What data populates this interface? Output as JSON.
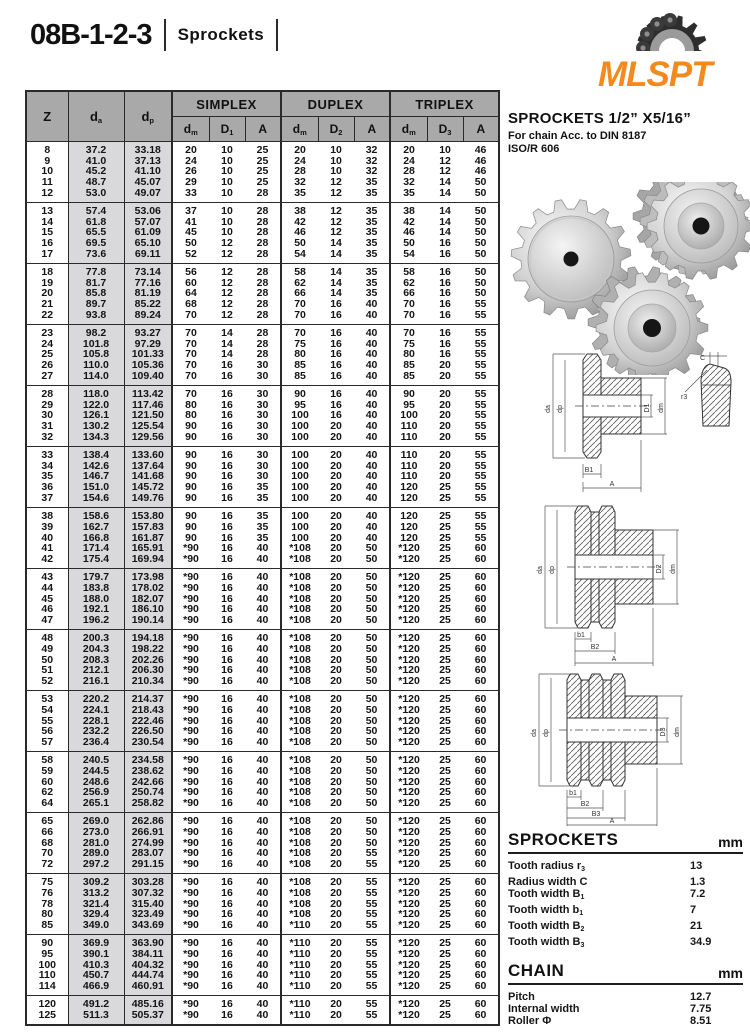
{
  "page": {
    "title": "08B-1-2-3",
    "subtitle": "Sprockets",
    "logo_text": "MLSPT",
    "accent_color": "#F28A1E"
  },
  "table": {
    "header": {
      "z": "Z",
      "da": {
        "b": "d",
        "s": "a"
      },
      "dp": {
        "b": "d",
        "s": "p"
      },
      "groups": [
        "SIMPLEX",
        "DUPLEX",
        "TRIPLEX"
      ],
      "subcols": [
        {
          "b": "d",
          "s": "m"
        },
        {
          "b": "D",
          "s": "1"
        },
        {
          "b": "A",
          "s": ""
        },
        {
          "b": "d",
          "s": "m"
        },
        {
          "b": "D",
          "s": "2"
        },
        {
          "b": "A",
          "s": ""
        },
        {
          "b": "d",
          "s": "m"
        },
        {
          "b": "D",
          "s": "3"
        },
        {
          "b": "A",
          "s": ""
        }
      ]
    },
    "groups": [
      [
        [
          "8",
          "37.2",
          "33.18",
          "20",
          "10",
          "25",
          "20",
          "10",
          "32",
          "20",
          "10",
          "46"
        ],
        [
          "9",
          "41.0",
          "37.13",
          "24",
          "10",
          "25",
          "24",
          "10",
          "32",
          "24",
          "12",
          "46"
        ],
        [
          "10",
          "45.2",
          "41.10",
          "26",
          "10",
          "25",
          "28",
          "10",
          "32",
          "28",
          "12",
          "46"
        ],
        [
          "11",
          "48.7",
          "45.07",
          "29",
          "10",
          "25",
          "32",
          "12",
          "35",
          "32",
          "14",
          "50"
        ],
        [
          "12",
          "53.0",
          "49.07",
          "33",
          "10",
          "28",
          "35",
          "12",
          "35",
          "35",
          "14",
          "50"
        ]
      ],
      [
        [
          "13",
          "57.4",
          "53.06",
          "37",
          "10",
          "28",
          "38",
          "12",
          "35",
          "38",
          "14",
          "50"
        ],
        [
          "14",
          "61.8",
          "57.07",
          "41",
          "10",
          "28",
          "42",
          "12",
          "35",
          "42",
          "14",
          "50"
        ],
        [
          "15",
          "65.5",
          "61.09",
          "45",
          "10",
          "28",
          "46",
          "12",
          "35",
          "46",
          "14",
          "50"
        ],
        [
          "16",
          "69.5",
          "65.10",
          "50",
          "12",
          "28",
          "50",
          "14",
          "35",
          "50",
          "16",
          "50"
        ],
        [
          "17",
          "73.6",
          "69.11",
          "52",
          "12",
          "28",
          "54",
          "14",
          "35",
          "54",
          "16",
          "50"
        ]
      ],
      [
        [
          "18",
          "77.8",
          "73.14",
          "56",
          "12",
          "28",
          "58",
          "14",
          "35",
          "58",
          "16",
          "50"
        ],
        [
          "19",
          "81.7",
          "77.16",
          "60",
          "12",
          "28",
          "62",
          "14",
          "35",
          "62",
          "16",
          "50"
        ],
        [
          "20",
          "85.8",
          "81.19",
          "64",
          "12",
          "28",
          "66",
          "14",
          "35",
          "66",
          "16",
          "50"
        ],
        [
          "21",
          "89.7",
          "85.22",
          "68",
          "12",
          "28",
          "70",
          "16",
          "40",
          "70",
          "16",
          "55"
        ],
        [
          "22",
          "93.8",
          "89.24",
          "70",
          "12",
          "28",
          "70",
          "16",
          "40",
          "70",
          "16",
          "55"
        ]
      ],
      [
        [
          "23",
          "98.2",
          "93.27",
          "70",
          "14",
          "28",
          "70",
          "16",
          "40",
          "70",
          "16",
          "55"
        ],
        [
          "24",
          "101.8",
          "97.29",
          "70",
          "14",
          "28",
          "75",
          "16",
          "40",
          "75",
          "16",
          "55"
        ],
        [
          "25",
          "105.8",
          "101.33",
          "70",
          "14",
          "28",
          "80",
          "16",
          "40",
          "80",
          "16",
          "55"
        ],
        [
          "26",
          "110.0",
          "105.36",
          "70",
          "16",
          "30",
          "85",
          "16",
          "40",
          "85",
          "20",
          "55"
        ],
        [
          "27",
          "114.0",
          "109.40",
          "70",
          "16",
          "30",
          "85",
          "16",
          "40",
          "85",
          "20",
          "55"
        ]
      ],
      [
        [
          "28",
          "118.0",
          "113.42",
          "70",
          "16",
          "30",
          "90",
          "16",
          "40",
          "90",
          "20",
          "55"
        ],
        [
          "29",
          "122.0",
          "117.46",
          "80",
          "16",
          "30",
          "95",
          "16",
          "40",
          "95",
          "20",
          "55"
        ],
        [
          "30",
          "126.1",
          "121.50",
          "80",
          "16",
          "30",
          "100",
          "16",
          "40",
          "100",
          "20",
          "55"
        ],
        [
          "31",
          "130.2",
          "125.54",
          "90",
          "16",
          "30",
          "100",
          "20",
          "40",
          "110",
          "20",
          "55"
        ],
        [
          "32",
          "134.3",
          "129.56",
          "90",
          "16",
          "30",
          "100",
          "20",
          "40",
          "110",
          "20",
          "55"
        ]
      ],
      [
        [
          "33",
          "138.4",
          "133.60",
          "90",
          "16",
          "30",
          "100",
          "20",
          "40",
          "110",
          "20",
          "55"
        ],
        [
          "34",
          "142.6",
          "137.64",
          "90",
          "16",
          "30",
          "100",
          "20",
          "40",
          "110",
          "20",
          "55"
        ],
        [
          "35",
          "146.7",
          "141.68",
          "90",
          "16",
          "30",
          "100",
          "20",
          "40",
          "110",
          "20",
          "55"
        ],
        [
          "36",
          "151.0",
          "145.72",
          "90",
          "16",
          "35",
          "100",
          "20",
          "40",
          "120",
          "25",
          "55"
        ],
        [
          "37",
          "154.6",
          "149.76",
          "90",
          "16",
          "35",
          "100",
          "20",
          "40",
          "120",
          "25",
          "55"
        ]
      ],
      [
        [
          "38",
          "158.6",
          "153.80",
          "90",
          "16",
          "35",
          "100",
          "20",
          "40",
          "120",
          "25",
          "55"
        ],
        [
          "39",
          "162.7",
          "157.83",
          "90",
          "16",
          "35",
          "100",
          "20",
          "40",
          "120",
          "25",
          "55"
        ],
        [
          "40",
          "166.8",
          "161.87",
          "90",
          "16",
          "35",
          "100",
          "20",
          "40",
          "120",
          "25",
          "55"
        ],
        [
          "41",
          "171.4",
          "165.91",
          "*90",
          "16",
          "40",
          "*108",
          "20",
          "50",
          "*120",
          "25",
          "60"
        ],
        [
          "42",
          "175.4",
          "169.94",
          "*90",
          "16",
          "40",
          "*108",
          "20",
          "50",
          "*120",
          "25",
          "60"
        ]
      ],
      [
        [
          "43",
          "179.7",
          "173.98",
          "*90",
          "16",
          "40",
          "*108",
          "20",
          "50",
          "*120",
          "25",
          "60"
        ],
        [
          "44",
          "183.8",
          "178.02",
          "*90",
          "16",
          "40",
          "*108",
          "20",
          "50",
          "*120",
          "25",
          "60"
        ],
        [
          "45",
          "188.0",
          "182.07",
          "*90",
          "16",
          "40",
          "*108",
          "20",
          "50",
          "*120",
          "25",
          "60"
        ],
        [
          "46",
          "192.1",
          "186.10",
          "*90",
          "16",
          "40",
          "*108",
          "20",
          "50",
          "*120",
          "25",
          "60"
        ],
        [
          "47",
          "196.2",
          "190.14",
          "*90",
          "16",
          "40",
          "*108",
          "20",
          "50",
          "*120",
          "25",
          "60"
        ]
      ],
      [
        [
          "48",
          "200.3",
          "194.18",
          "*90",
          "16",
          "40",
          "*108",
          "20",
          "50",
          "*120",
          "25",
          "60"
        ],
        [
          "49",
          "204.3",
          "198.22",
          "*90",
          "16",
          "40",
          "*108",
          "20",
          "50",
          "*120",
          "25",
          "60"
        ],
        [
          "50",
          "208.3",
          "202.26",
          "*90",
          "16",
          "40",
          "*108",
          "20",
          "50",
          "*120",
          "25",
          "60"
        ],
        [
          "51",
          "212.1",
          "206.30",
          "*90",
          "16",
          "40",
          "*108",
          "20",
          "50",
          "*120",
          "25",
          "60"
        ],
        [
          "52",
          "216.1",
          "210.34",
          "*90",
          "16",
          "40",
          "*108",
          "20",
          "50",
          "*120",
          "25",
          "60"
        ]
      ],
      [
        [
          "53",
          "220.2",
          "214.37",
          "*90",
          "16",
          "40",
          "*108",
          "20",
          "50",
          "*120",
          "25",
          "60"
        ],
        [
          "54",
          "224.1",
          "218.43",
          "*90",
          "16",
          "40",
          "*108",
          "20",
          "50",
          "*120",
          "25",
          "60"
        ],
        [
          "55",
          "228.1",
          "222.46",
          "*90",
          "16",
          "40",
          "*108",
          "20",
          "50",
          "*120",
          "25",
          "60"
        ],
        [
          "56",
          "232.2",
          "226.50",
          "*90",
          "16",
          "40",
          "*108",
          "20",
          "50",
          "*120",
          "25",
          "60"
        ],
        [
          "57",
          "236.4",
          "230.54",
          "*90",
          "16",
          "40",
          "*108",
          "20",
          "50",
          "*120",
          "25",
          "60"
        ]
      ],
      [
        [
          "58",
          "240.5",
          "234.58",
          "*90",
          "16",
          "40",
          "*108",
          "20",
          "50",
          "*120",
          "25",
          "60"
        ],
        [
          "59",
          "244.5",
          "238.62",
          "*90",
          "16",
          "40",
          "*108",
          "20",
          "50",
          "*120",
          "25",
          "60"
        ],
        [
          "60",
          "248.6",
          "242.66",
          "*90",
          "16",
          "40",
          "*108",
          "20",
          "50",
          "*120",
          "25",
          "60"
        ],
        [
          "62",
          "256.9",
          "250.74",
          "*90",
          "16",
          "40",
          "*108",
          "20",
          "50",
          "*120",
          "25",
          "60"
        ],
        [
          "64",
          "265.1",
          "258.82",
          "*90",
          "16",
          "40",
          "*108",
          "20",
          "50",
          "*120",
          "25",
          "60"
        ]
      ],
      [
        [
          "65",
          "269.0",
          "262.86",
          "*90",
          "16",
          "40",
          "*108",
          "20",
          "50",
          "*120",
          "25",
          "60"
        ],
        [
          "66",
          "273.0",
          "266.91",
          "*90",
          "16",
          "40",
          "*108",
          "20",
          "50",
          "*120",
          "25",
          "60"
        ],
        [
          "68",
          "281.0",
          "274.99",
          "*90",
          "16",
          "40",
          "*108",
          "20",
          "50",
          "*120",
          "25",
          "60"
        ],
        [
          "70",
          "289.0",
          "283.07",
          "*90",
          "16",
          "40",
          "*108",
          "20",
          "55",
          "*120",
          "25",
          "60"
        ],
        [
          "72",
          "297.2",
          "291.15",
          "*90",
          "16",
          "40",
          "*108",
          "20",
          "55",
          "*120",
          "25",
          "60"
        ]
      ],
      [
        [
          "75",
          "309.2",
          "303.28",
          "*90",
          "16",
          "40",
          "*108",
          "20",
          "55",
          "*120",
          "25",
          "60"
        ],
        [
          "76",
          "313.2",
          "307.32",
          "*90",
          "16",
          "40",
          "*108",
          "20",
          "55",
          "*120",
          "25",
          "60"
        ],
        [
          "78",
          "321.4",
          "315.40",
          "*90",
          "16",
          "40",
          "*108",
          "20",
          "55",
          "*120",
          "25",
          "60"
        ],
        [
          "80",
          "329.4",
          "323.49",
          "*90",
          "16",
          "40",
          "*108",
          "20",
          "55",
          "*120",
          "25",
          "60"
        ],
        [
          "85",
          "349.0",
          "343.69",
          "*90",
          "16",
          "40",
          "*110",
          "20",
          "55",
          "*120",
          "25",
          "60"
        ]
      ],
      [
        [
          "90",
          "369.9",
          "363.90",
          "*90",
          "16",
          "40",
          "*110",
          "20",
          "55",
          "*120",
          "25",
          "60"
        ],
        [
          "95",
          "390.1",
          "384.11",
          "*90",
          "16",
          "40",
          "*110",
          "20",
          "55",
          "*120",
          "25",
          "60"
        ],
        [
          "100",
          "410.3",
          "404.32",
          "*90",
          "16",
          "40",
          "*110",
          "20",
          "55",
          "*120",
          "25",
          "60"
        ],
        [
          "110",
          "450.7",
          "444.74",
          "*90",
          "16",
          "40",
          "*110",
          "20",
          "55",
          "*120",
          "25",
          "60"
        ],
        [
          "114",
          "466.9",
          "460.91",
          "*90",
          "16",
          "40",
          "*110",
          "20",
          "55",
          "*120",
          "25",
          "60"
        ]
      ],
      [
        [
          "120",
          "491.2",
          "485.16",
          "*90",
          "16",
          "40",
          "*110",
          "20",
          "55",
          "*120",
          "25",
          "60"
        ],
        [
          "125",
          "511.3",
          "505.37",
          "*90",
          "16",
          "40",
          "*110",
          "20",
          "55",
          "*120",
          "25",
          "60"
        ]
      ]
    ]
  },
  "right": {
    "heading": "SPROCKETS  1/2” X5/16”",
    "subheading1": "For chain Acc. to DIN 8187",
    "subheading2": "ISO/R 606",
    "sprockets_spec": {
      "title": "SPROCKETS",
      "unit": "mm",
      "rows": [
        {
          "label": "Tooth radius r",
          "sub": "3",
          "value": "13"
        },
        {
          "label": "Radius width C",
          "sub": "",
          "value": "1.3"
        },
        {
          "label": "Tooth width B",
          "sub": "1",
          "value": "7.2"
        },
        {
          "label": "Tooth width b",
          "sub": "1",
          "value": "7"
        },
        {
          "label": "Tooth width B",
          "sub": "2",
          "value": "21"
        },
        {
          "label": "Tooth width B",
          "sub": "3",
          "value": "34.9"
        }
      ]
    },
    "chain_spec": {
      "title": "CHAIN",
      "unit": "mm",
      "rows": [
        {
          "label": "Pitch",
          "sub": "",
          "value": "12.7"
        },
        {
          "label": "Internal width",
          "sub": "",
          "value": "7.75"
        },
        {
          "label": "Roller Φ",
          "sub": "",
          "value": "8.51"
        }
      ]
    },
    "material": "Material: C 45",
    "weld_note": "*Weld on hub"
  },
  "drawings": {
    "simplex": {
      "da": "da",
      "dp": "dp",
      "bore": "D1",
      "hub": "dm",
      "w1": "B1",
      "a": "A",
      "c": "C",
      "r3": "r3"
    },
    "duplex": {
      "da": "da",
      "dp": "dp",
      "bore": "D2",
      "hub": "dm",
      "w1": "b1",
      "w2": "B2",
      "a": "A"
    },
    "triplex": {
      "da": "da",
      "dp": "dp",
      "bore": "D3",
      "hub": "dm",
      "w1": "b1",
      "w2": "B2",
      "w3": "B3",
      "a": "A"
    }
  }
}
